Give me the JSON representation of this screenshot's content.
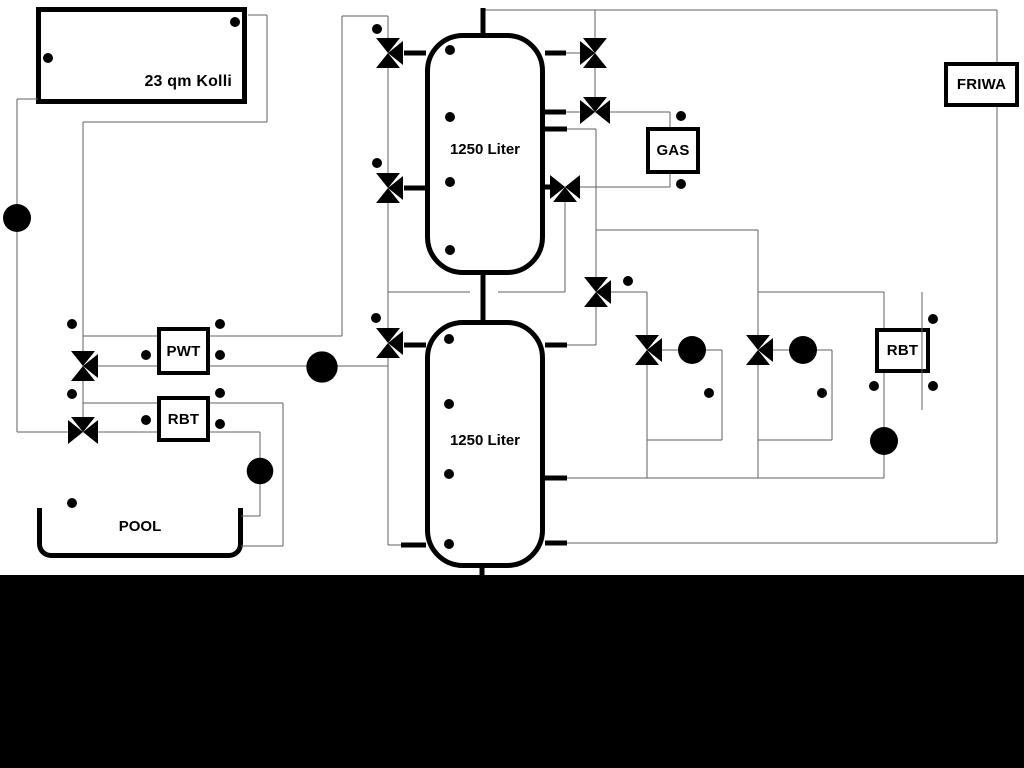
{
  "diagram": {
    "collector": {
      "label": "23 qm Kolli"
    },
    "tanks": [
      {
        "label": "1250 Liter"
      },
      {
        "label": "1250 Liter"
      }
    ],
    "heat_exchangers": {
      "pwt": "PWT",
      "rbt_left": "RBT",
      "rbt_right": "RBT"
    },
    "boiler": {
      "label": "GAS"
    },
    "fresh_water_station": {
      "label": "FRIWA"
    },
    "pool": {
      "label": "POOL"
    },
    "icon_legend": {
      "pump-icon": "circle with filled triangle showing flow direction",
      "three-way-valve-icon": "three open triangles meeting at a point",
      "temperature-sensor-icon": "small circle with stem tick"
    },
    "colors": {
      "pipe": "#606060",
      "thick_pipe": "#000000",
      "symbol": "#000000",
      "background": "#ffffff",
      "bottom_mask": "#000000"
    }
  }
}
